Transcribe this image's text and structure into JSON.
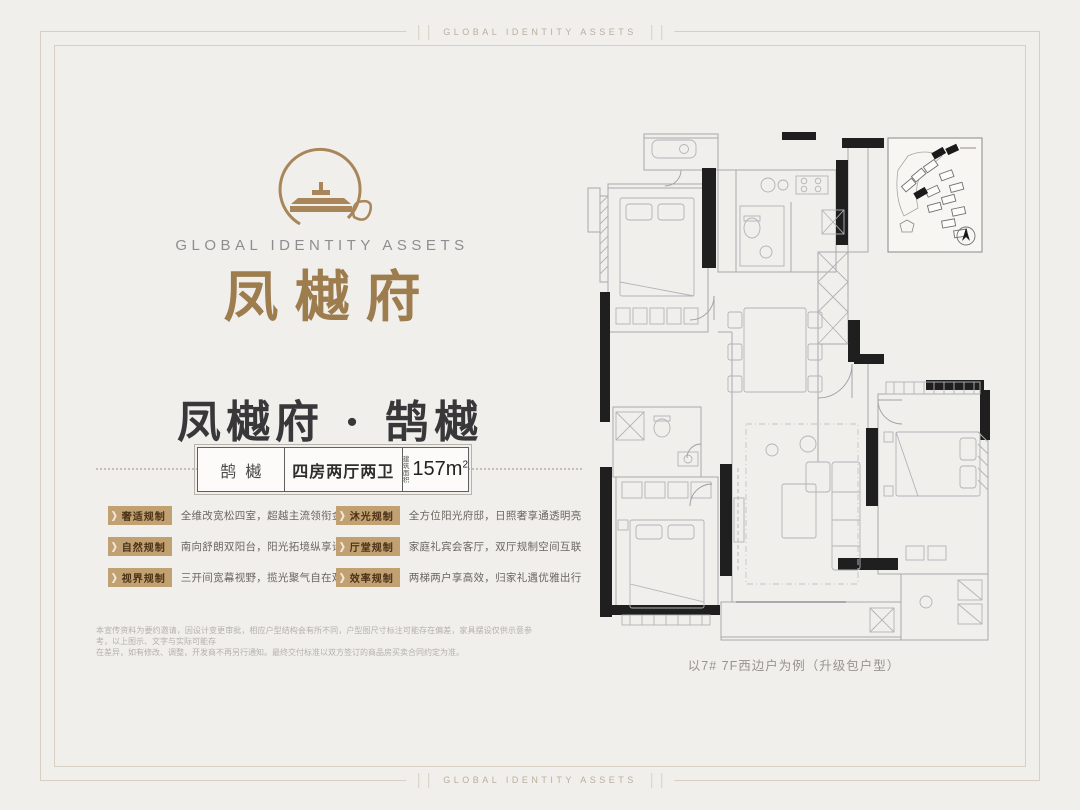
{
  "border_frame": {
    "top_label": "GLOBAL IDENTITY ASSETS",
    "bottom_label": "GLOBAL IDENTITY ASSETS"
  },
  "brand": {
    "logo_english": "GLOBAL IDENTITY ASSETS",
    "logo_chinese": "凤樾府"
  },
  "headline": {
    "title": "凤樾府 · 鹄樾"
  },
  "spec_box": {
    "series_name": "鹄樾",
    "layout": "四房两厅两卫",
    "area_label_line1": "建筑",
    "area_label_line2": "面积",
    "area_value": "157m",
    "area_superscript": "2"
  },
  "features": {
    "left": [
      {
        "tag": "奢适规制",
        "desc": "全维改宽松四室，超越主流领衔金陵"
      },
      {
        "tag": "自然规制",
        "desc": "南向舒朗双阳台，阳光拓境纵享诗意"
      },
      {
        "tag": "视界规制",
        "desc": "三开间宽幕视野，揽光聚气自在观景"
      }
    ],
    "right": [
      {
        "tag": "沐光规制",
        "desc": "全方位阳光府邸，日照奢享通透明亮"
      },
      {
        "tag": "厅堂规制",
        "desc": "家庭礼宾会客厅，双厅规制空间互联"
      },
      {
        "tag": "效率规制",
        "desc": "两梯两户享高效，归家礼遇优雅出行"
      }
    ]
  },
  "disclaimer": {
    "line1": "本宣传资料为要约邀请，因设计变更审批，相应户型结构会有所不同，户型图尺寸标注可能存在偏差，家具摆设仅供示意参考，以上图示、文字与实际可能存",
    "line2": "在差异，如有修改、调整，开发商不再另行通知。最终交付标准以双方签订的商品房买卖合同约定为准。"
  },
  "floor_plan": {
    "caption": "以7# 7F西边户为例（升级包户型）"
  },
  "colors": {
    "bronze": "#9d7c4d",
    "badge_background": "#c1a072",
    "badge_text": "#4a3115",
    "title_ink": "#38383a",
    "frame_line": "#d6cfc2",
    "wall_black": "#1f1f1f",
    "plan_line": "#a6a9ad",
    "page_background": "#f1efec"
  }
}
